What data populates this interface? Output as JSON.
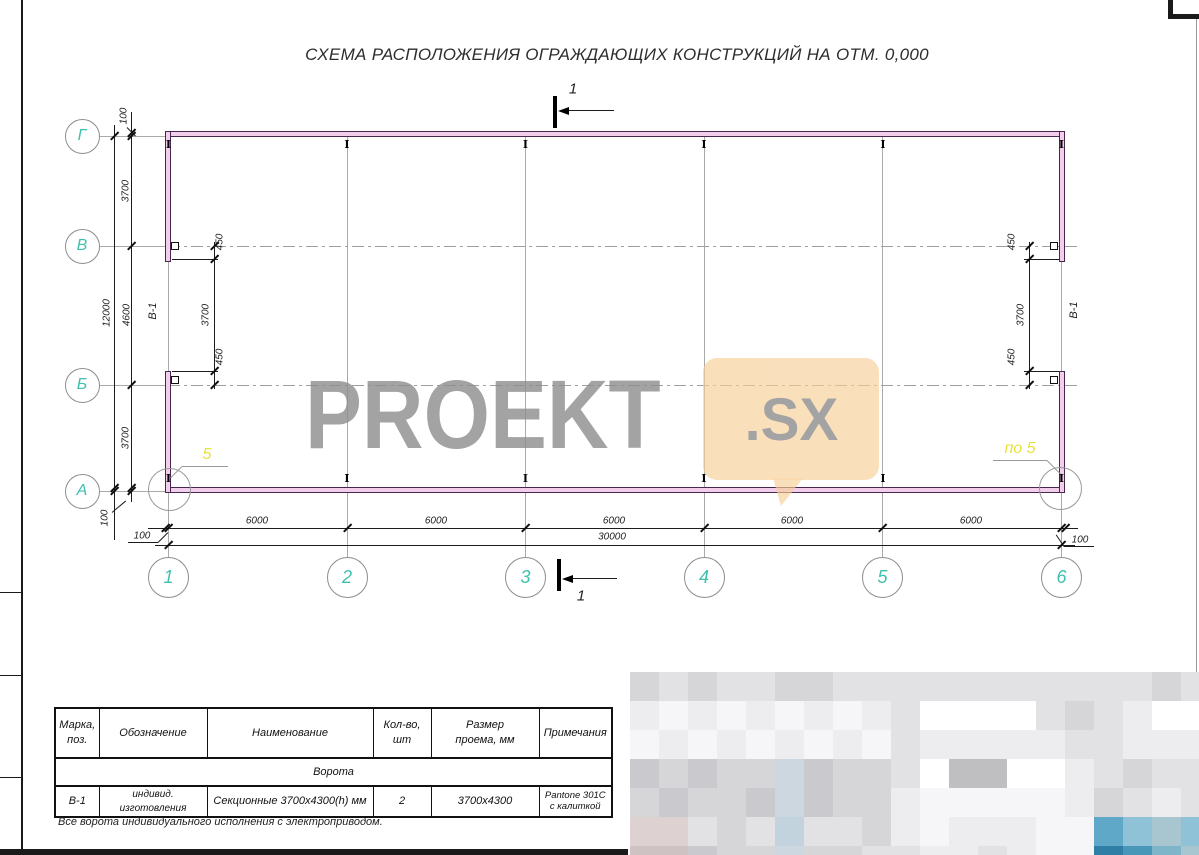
{
  "title": "СХЕМА РАСПОЛОЖЕНИЯ ОГРАЖДАЮЩИХ КОНСТРУКЦИЙ НА ОТМ. 0,000",
  "colors": {
    "axis_label_teal": "#3ec0ad",
    "wall_fill_pink": "#f3cdec",
    "wall_edge_purple": "#46284e",
    "accent_yellow": "#e6e23c",
    "watermark_gray": "#8f8f91",
    "watermark_bubble_orange": "#f7ce98"
  },
  "plan": {
    "row_axes": [
      "Г",
      "В",
      "Б",
      "А"
    ],
    "col_axes": [
      "1",
      "2",
      "3",
      "4",
      "5",
      "6"
    ],
    "dims": {
      "offset": "100",
      "left_segments": [
        "3700",
        "4600",
        "3700"
      ],
      "left_total": "12000",
      "bottom_segments": [
        "6000",
        "6000",
        "6000",
        "6000",
        "6000"
      ],
      "bottom_total": "30000"
    },
    "gate": {
      "mark": "В-1",
      "jamb_offset": "450",
      "opening": "3700"
    },
    "section": {
      "label": "1"
    },
    "details": {
      "left": "5",
      "right": "по 5"
    }
  },
  "watermark": {
    "text": "PROEKT",
    "suffix": ".SX"
  },
  "table": {
    "headers": [
      "Марка,\nпоз.",
      "Обозначение",
      "Наименование",
      "Кол-во,\nшт",
      "Размер\nпроема, мм",
      "Примечания"
    ],
    "group_row": "Ворота",
    "rows": [
      [
        "В-1",
        "индивид. изготовления",
        "Секционные 3700х4300(h) мм",
        "2",
        "3700х4300",
        "Pantone 301C\nс калиткой"
      ]
    ],
    "note": "Все ворота индивидуального исполнения с электроприводом."
  },
  "mosaic": {
    "palette": {
      "W": "#ffffff",
      "A": "#f6f6f8",
      "B": "#ededef",
      "C": "#e2e2e4",
      "D": "#d6d6d8",
      "E": "#cacace",
      "F": "#bfbfc1",
      "G": "#ccd7df",
      "H": "#c2d3dd",
      "P": "#ddd1d1",
      "Q": "#cfc2c2",
      "t": "#8fc2d6",
      "T": "#5fa8c8",
      "U": "#4896b8",
      "V": "#2e7ea6",
      "S": "#a7c6d0",
      "R": "#7fb5c9"
    },
    "rows": [
      [
        "D",
        "C",
        "D",
        "C",
        "C",
        "D",
        "D",
        "C",
        "C",
        "C",
        "C",
        "C",
        "C",
        "C",
        "C",
        "C",
        "C",
        "C",
        "D",
        "C"
      ],
      [
        "B",
        "A",
        "B",
        "A",
        "B",
        "A",
        "B",
        "A",
        "B",
        "C",
        "W",
        "W",
        "W",
        "W",
        "C",
        "D",
        "C",
        "B",
        "W",
        "W"
      ],
      [
        "A",
        "B",
        "A",
        "B",
        "A",
        "B",
        "A",
        "B",
        "A",
        "C",
        "B",
        "B",
        "B",
        "B",
        "B",
        "C",
        "C",
        "B",
        "B",
        "B"
      ],
      [
        "E",
        "D",
        "E",
        "D",
        "D",
        "G",
        "E",
        "D",
        "D",
        "C",
        "W",
        "F",
        "F",
        "W",
        "W",
        "B",
        "C",
        "D",
        "C",
        "C"
      ],
      [
        "D",
        "E",
        "D",
        "D",
        "E",
        "G",
        "E",
        "D",
        "D",
        "B",
        "A",
        "A",
        "A",
        "A",
        "A",
        "B",
        "D",
        "C",
        "B",
        "C"
      ],
      [
        "P",
        "P",
        "C",
        "D",
        "C",
        "H",
        "C",
        "C",
        "D",
        "B",
        "A",
        "B",
        "B",
        "B",
        "A",
        "A",
        "T",
        "t",
        "S",
        "t"
      ],
      [
        "Q",
        "Q",
        "E",
        "D",
        "D",
        "G",
        "D",
        "D",
        "C",
        "C",
        "B",
        "B",
        "C",
        "B",
        "A",
        "A",
        "V",
        "U",
        "R",
        "S"
      ]
    ]
  }
}
